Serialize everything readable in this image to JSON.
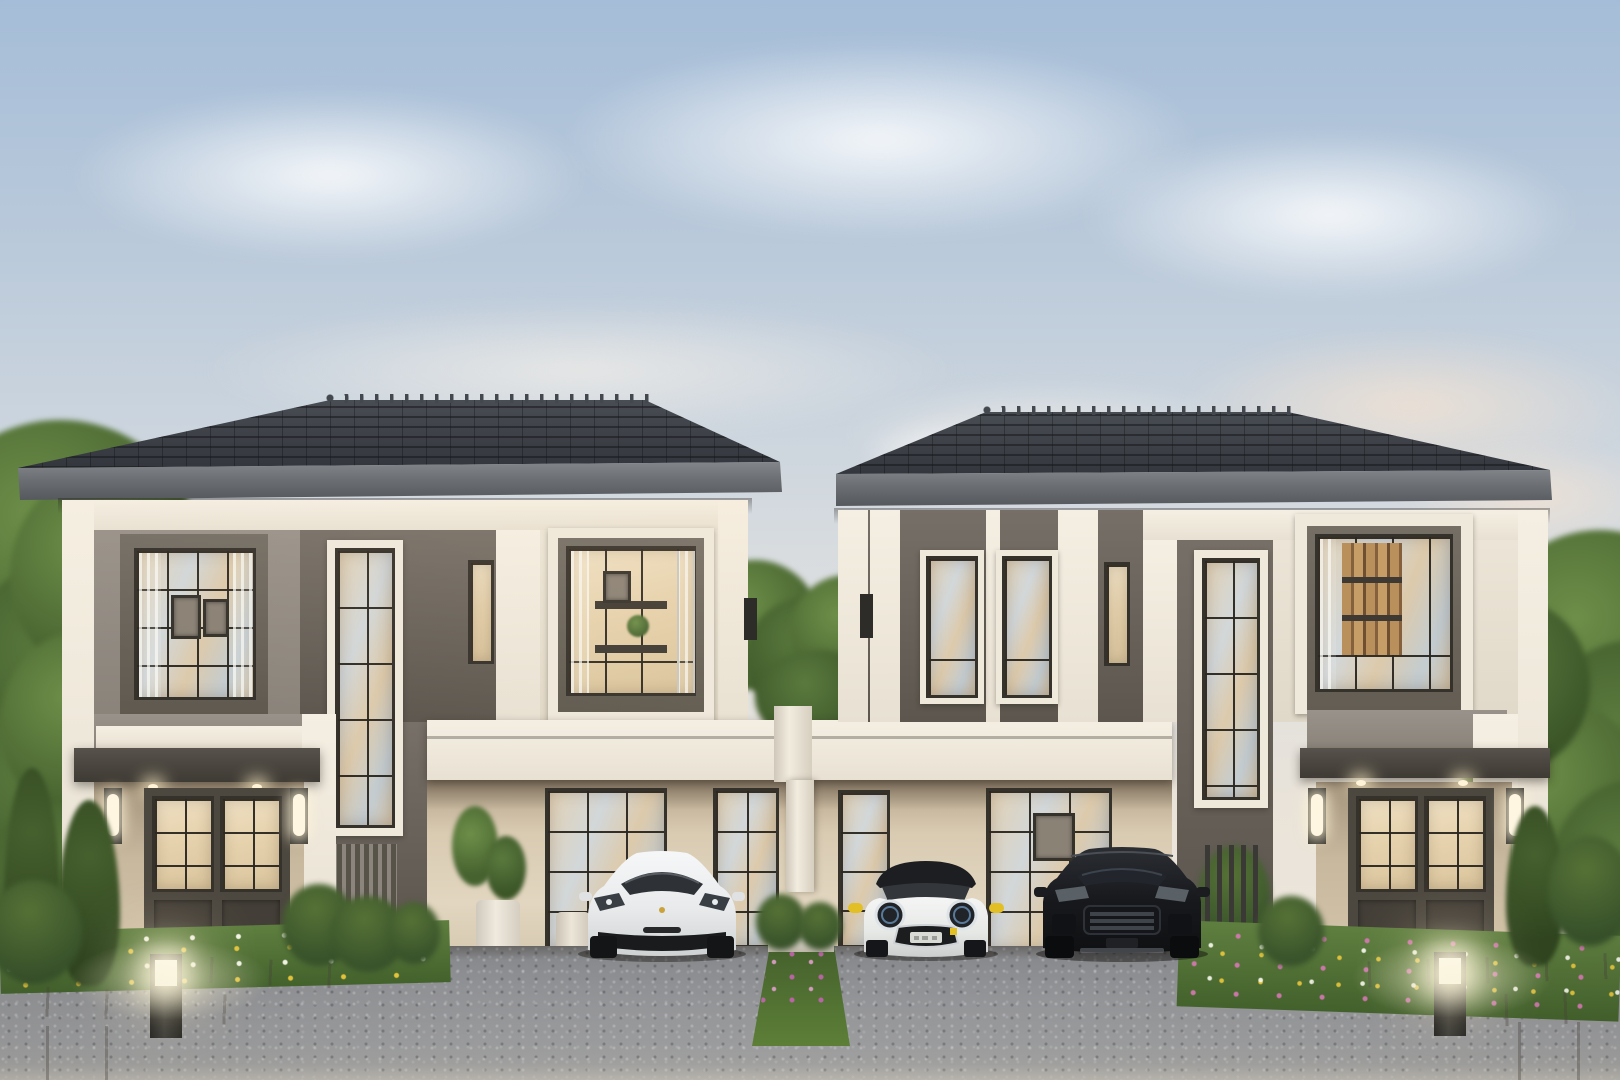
{
  "scene": {
    "description": "Dusk 3D architectural rendering of modern two-storey twin houses with a shared central carport, three parked cars, flower beds, stone walkways and glowing bollard lights",
    "labels": {
      "sky": "Evening sky with soft clouds",
      "house_left": "Left twin house with hipped tile roof",
      "house_right": "Right twin house with hipped tile roof",
      "roof_left": "Left dark hipped tile roof",
      "roof_right": "Right dark hipped tile roof",
      "carport_band": "Shared carport fascia band",
      "divider_column": "White carport divider column",
      "car_sedan": "White electric sports sedan parked in left carport",
      "car_mini": "White compact hatchback with black roof and yellow mirrors",
      "car_suv": "Black luxury SUV parked in right carport",
      "driveway": "Gravel driveway forecourt",
      "median_strip": "Planted median strip with purple flowers",
      "flowerbed_left": "Flower bed with white and yellow blossoms",
      "flowerbed_right": "Flower bed with pink, white and yellow blossoms",
      "bollard_left": "Glowing garden bollard light",
      "bollard_right": "Glowing garden bollard light",
      "trees_left": "Tall green trees behind left house",
      "trees_right": "Tall green trees behind right house",
      "tree_center": "Tree in the gap between houses",
      "entrance_left": "Left house entrance with canopy, glazed double door and wall lights",
      "entrance_right": "Right house entrance with canopy, glazed double door and wall lights",
      "window_upper_left": "Upper-floor gridded window with framed pictures inside",
      "window_tall_left": "Double-height gridded feature window",
      "window_bedroom_left": "Upper-floor window with shelving interior",
      "window_tall_right": "Double-height gridded feature window",
      "window_bookshelf_right": "Upper-floor window with bookshelf interior",
      "carport_windows": "Ground-floor gridded windows behind cars",
      "fence_right": "Dark slatted fence panel",
      "plant_pot": "Potted plant in carport"
    },
    "palette": {
      "sky_top": "#a5bdd8",
      "sky_horizon": "#efe8dc",
      "roof": "#383b40",
      "fascia": "#6c6f73",
      "facade_white": "#f2ecdf",
      "facade_gray": "#918a80",
      "accent_dark": "#6b645c",
      "carport_wall": "#ddd1ba",
      "window_frame": "#35312b",
      "glass_warm": "#dcc9ab",
      "driveway": "#909194",
      "grass": "#5d7c3e",
      "flower_yellow": "#e5c238",
      "flower_white": "#f6f4e8",
      "flower_pink": "#c06fa0",
      "car_white": "#edeff0",
      "car_black": "#17191d",
      "mini_accent_yellow": "#e2bf25"
    }
  }
}
